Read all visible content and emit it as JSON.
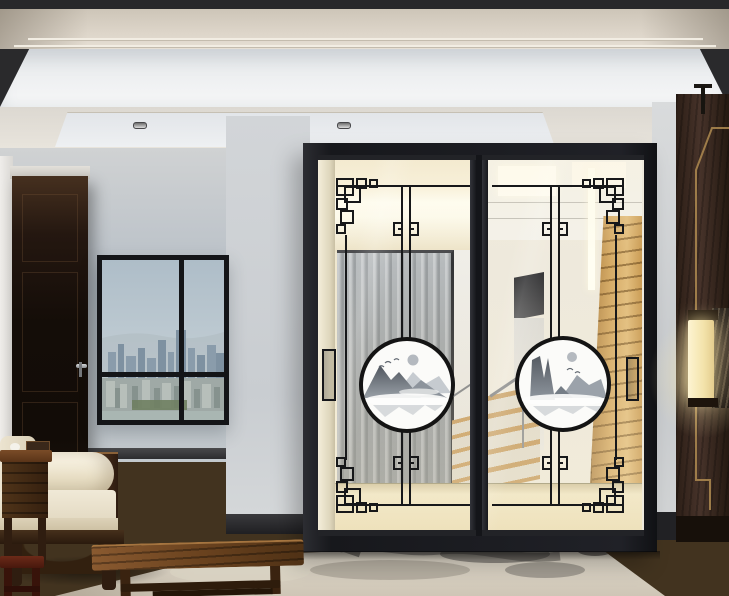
{
  "scene": {
    "title": "Modern Chinese living room with decorated sliding glass doors",
    "elements": {
      "ceiling": "recessed tray ceiling with three spotlights",
      "left_wall": "blue-gray wall with four-pane city-view window and dark wooden door",
      "sliding_door": "black framed two-panel glass sliding door with Chinese fret lattice corners and round ink-wash mountain medallions",
      "hallway": "hallway behind glass with mirror wardrobe, staircase with handrail and wood slat wall",
      "right_wall": "dark walnut panel with brass trim, hanging rod and glowing fabric sconce",
      "floor": "dark wood plank floor with ink-brush area rug",
      "furniture": "white daybed sofa with bolster, wooden tray table, low wooden tea table and small corner bench"
    },
    "palette": {
      "ceiling_cream": "#ddd6cb",
      "cove_white": "#eef0f2",
      "wall_blue_gray": "#b9c0c7",
      "pillar_gray": "#ccd0d4",
      "frame_black": "#1e1f23",
      "glass_warm_tint": "#efe8d6",
      "lattice_black": "#17181a",
      "medallion_white": "#fbfbf9",
      "mountain_gray": "#555b63",
      "wood_slat_tan": "#d4a964",
      "stair_wood": "#c59a5d",
      "dark_walnut": "#30211a",
      "brass_trim": "#a8854e",
      "lamp_glow": "#f5e7b4",
      "floor_brown": "#463626",
      "rug_beige": "#d5cec0",
      "sofa_cream": "#efe8d5",
      "table_wood": "#6b431f",
      "sky_blue": "#bcc8d0"
    },
    "counts": {
      "door_panels": 2,
      "medallions": 2,
      "spotlights": 3,
      "window_panes": 4
    }
  }
}
